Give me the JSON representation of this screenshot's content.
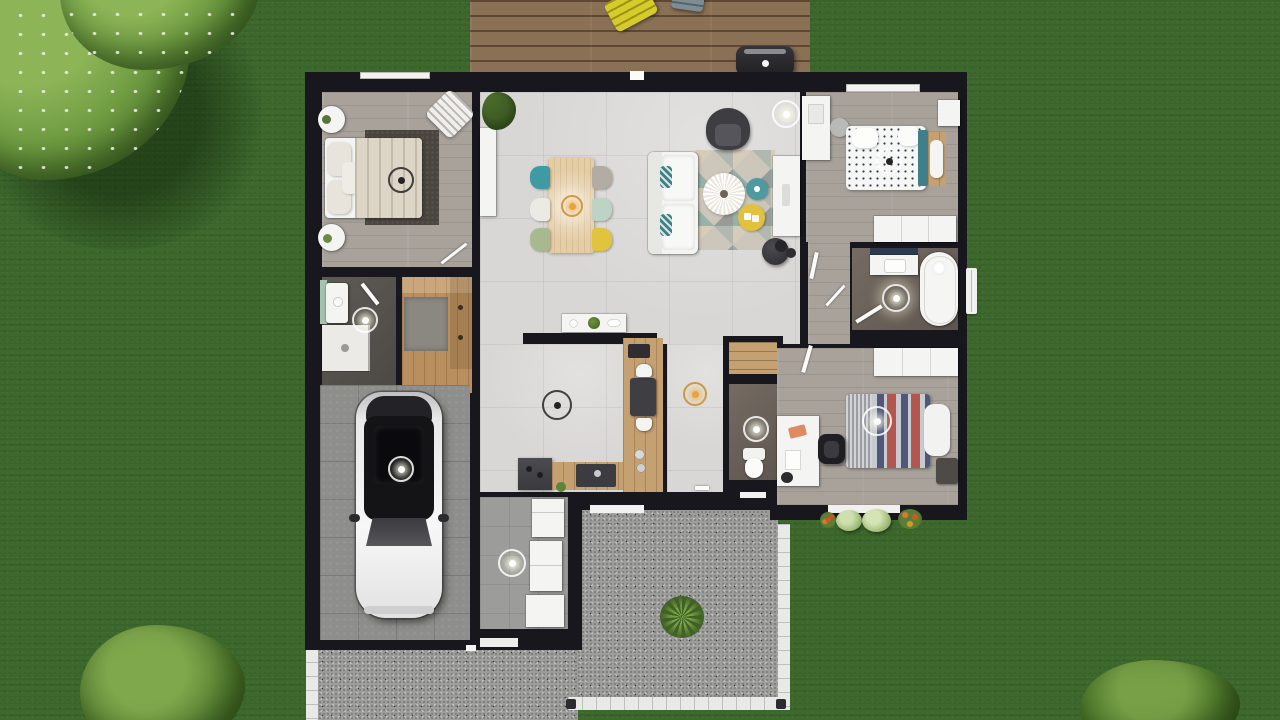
{
  "scene": {
    "type": "3d-floor-plan-render",
    "view": "top-down",
    "setting": "single-storey house on green lawn",
    "visible_text": ""
  },
  "palette": {
    "grass": "#3c682c",
    "walls": "#17171d",
    "tile_floor": "#d8d7d5",
    "gray_wood_floor": "#a8a29b",
    "tan_wood": "#c5a172",
    "deck_wood": "#8a7055",
    "paving_gravel": "#9d9d9b",
    "white_furniture": "#f4f4f2",
    "accent_teal": "#3f9aa3",
    "accent_mint": "#bdd3c5",
    "accent_sage": "#a9b98f",
    "accent_yellow": "#e2c33e",
    "accent_orange": "#e08a2f",
    "duvet_navy": "#50587a",
    "duvet_red": "#b2564e",
    "rug_dark": "#4b453f"
  },
  "outdoor": {
    "vegetation": [
      "flowering-tree-top-left",
      "tree-bottom-left",
      "bush-bottom-right",
      "shrubs-south-of-bedroom-3",
      "potted-shrub-on-terrace"
    ],
    "deck": {
      "name": "wood deck",
      "items": [
        "yellow-lounge-chair",
        "gray-chair",
        "bbq-grill"
      ]
    },
    "terrace": {
      "name": "gravel terrace",
      "border": "white tile edging",
      "items": [
        "potted-shrub",
        "corner-posts"
      ]
    },
    "driveway": {
      "name": "gravel driveway",
      "border": "white tile edging"
    }
  },
  "rooms": {
    "bedroom1": {
      "name": "Bedroom top-left",
      "floor": "gray wood",
      "furniture": [
        "double-bed",
        "dark-area-rug",
        "round-nightstand x2",
        "striped-accent-chair",
        "ceiling-fan-light"
      ]
    },
    "dining": {
      "name": "Dining area",
      "floor": "light tile",
      "furniture": [
        "wood-dining-table",
        "chairs: teal, cream, sage, gray, mint, yellow",
        "orange-pendant-light",
        "white-sideboard",
        "potted-plant"
      ]
    },
    "living": {
      "name": "Living area",
      "floor": "light tile",
      "furniture": [
        "white-sofa-with-teal-pillows",
        "geometric-rug",
        "round-coffee-table",
        "teal-side-table",
        "yellow-side-table",
        "dark-armchair",
        "dark-pouf",
        "tv-console",
        "ceiling-light"
      ]
    },
    "bedroom2": {
      "name": "Bedroom top-right",
      "floor": "gray wood",
      "furniture": [
        "dotted-duvet-bed",
        "teal-bench",
        "wood-headboard",
        "white-desk",
        "desk-chair",
        "wall-cabinet",
        "white-dresser",
        "ceiling-light"
      ]
    },
    "bathroom": {
      "name": "Bathroom",
      "floor": "dark taupe",
      "furniture": [
        "vanity-sink",
        "bathtub",
        "ceiling-light",
        "door"
      ]
    },
    "wc": {
      "name": "WC",
      "floor": "dark taupe",
      "furniture": [
        "toilet",
        "ceiling-light",
        "linen-closet"
      ]
    },
    "bedroom3": {
      "name": "Bedroom bottom-right",
      "floor": "gray wood",
      "furniture": [
        "striped-duvet-bed",
        "white-pillow",
        "white-wardrobe",
        "white-desk",
        "black-office-chair",
        "dark-nightstand",
        "ceiling-light"
      ]
    },
    "shower": {
      "name": "Shower room",
      "floor": "dark gray",
      "furniture": [
        "washbasin",
        "shower-tray",
        "ceiling-light",
        "door"
      ]
    },
    "dressing": {
      "name": "Walk-in closet",
      "floor": "wood with gray carpet",
      "furniture": [
        "u-shaped-wardrobe"
      ]
    },
    "kitchen": {
      "name": "Kitchen",
      "floor": "light tile + wood strip",
      "furniture": [
        "white-island",
        "wood-counter",
        "dark-sink-unit",
        "dark-range-unit",
        "small-table-with-2-white-chairs",
        "spot-lamp",
        "gold-pendant-in-corridor"
      ]
    },
    "laundry": {
      "name": "Laundry / utility",
      "floor": "gray tile",
      "furniture": [
        "fridge",
        "stacked-washer",
        "white-counter",
        "ceiling-light"
      ]
    },
    "garage": {
      "name": "Garage",
      "floor": "concrete tiles",
      "furniture": [
        "car",
        "ceiling-light"
      ]
    },
    "hallway": {
      "name": "Hallway",
      "floor": "tile + gray wood",
      "furniture": [
        "open-door-leaves"
      ]
    }
  }
}
